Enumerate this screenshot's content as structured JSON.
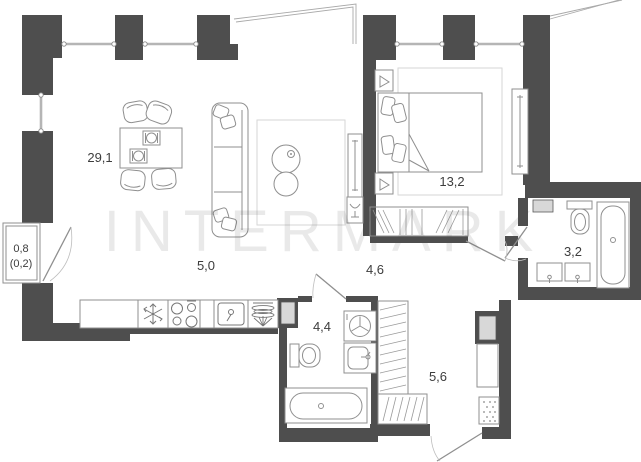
{
  "plan": {
    "watermark": "INTERMARK",
    "rooms": [
      {
        "id": "living-room",
        "label": "29,1"
      },
      {
        "id": "kitchen-zone",
        "label": "5,0"
      },
      {
        "id": "bedroom",
        "label": "13,2"
      },
      {
        "id": "hallway",
        "label": "4,6"
      },
      {
        "id": "bathroom",
        "label": "3,2"
      },
      {
        "id": "bathroom-2",
        "label": "4,4"
      },
      {
        "id": "corridor",
        "label": "5,6"
      },
      {
        "id": "balcony",
        "label": "0,8",
        "sublabel": "(0,2)"
      }
    ],
    "colors": {
      "wall": "#4e4e4e",
      "line": "#8f8f8f",
      "shaft": "#d8d8d8",
      "label": "#3d3d3d"
    }
  }
}
